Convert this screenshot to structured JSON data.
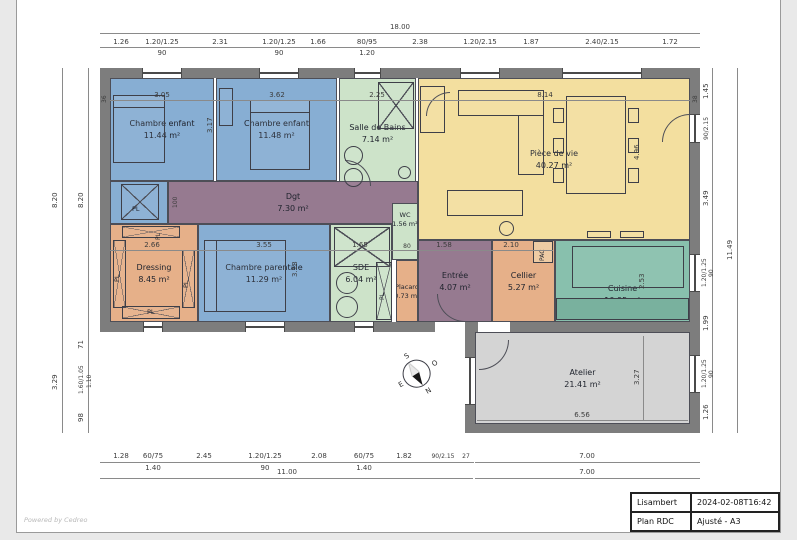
{
  "meta": {
    "watermark": "Powered by Cedreo"
  },
  "title_block": {
    "owner": "Lisambert",
    "timestamp": "2024-02-08T16:42",
    "plan_name": "Plan RDC",
    "variant": "Ajusté - A3"
  },
  "colors": {
    "blue": "#87aed3",
    "green": "#cde3c9",
    "yellow": "#f3df9f",
    "mauve": "#967a90",
    "orange": "#e6b089",
    "teal": "#88c0ad",
    "teal_dark": "#79b19e",
    "gray_room": "#d4d4d4",
    "wall": "#7d7d7d",
    "pac": "#e6b089"
  },
  "rooms": {
    "chambre1": {
      "name": "Chambre enfant",
      "area": "11.44 m²"
    },
    "chambre2": {
      "name": "Chambre enfant",
      "area": "11.48 m²"
    },
    "sdb": {
      "name": "Salle de Bains",
      "area": "7.14 m²"
    },
    "piece": {
      "name": "Pièce de vie",
      "area": "40.27 m²"
    },
    "dgt": {
      "name": "Dgt",
      "area": "7.30 m²"
    },
    "dressing": {
      "name": "Dressing",
      "area": "8.45 m²"
    },
    "parentale": {
      "name": "Chambre parentale",
      "area": "11.29 m²"
    },
    "sde": {
      "name": "SDE",
      "area": "6.04 m²"
    },
    "wc": {
      "name": "WC",
      "area": "1.56 m²"
    },
    "placard": {
      "name": "Placard",
      "area": "0.73 m²"
    },
    "entree": {
      "name": "Entrée",
      "area": "4.07 m²"
    },
    "cellier": {
      "name": "Cellier",
      "area": "5.27 m²"
    },
    "cuisine": {
      "name": "Cuisine",
      "area": "10.95 m²"
    },
    "atelier": {
      "name": "Atelier",
      "area": "21.41 m²"
    }
  },
  "labels": {
    "pl": "PL",
    "pac": "PAC"
  },
  "compass": {
    "top": "S",
    "right": "O",
    "bottom": "N",
    "left": "E"
  },
  "dims": {
    "top_overall": "18.00",
    "top": [
      "1.26",
      "1.20/1.25",
      "2.31",
      "1.20/1.25",
      "1.66",
      "80/95",
      "2.38",
      "1.20/2.15",
      "1.87",
      "2.40/2.15",
      "1.72"
    ],
    "top_sub": [
      "90",
      "90",
      "1.20"
    ],
    "bottom": [
      "1.28",
      "60/75",
      "2.45",
      "1.20/1.25",
      "2.08",
      "60/75",
      "1.82",
      "90/2.15",
      "27",
      "7.00"
    ],
    "bottom_sub": [
      "1.40",
      "90",
      "1.40"
    ],
    "bottom_overall": [
      "11.00",
      "7.00"
    ],
    "left_outer": [
      "8.20",
      "3.29"
    ],
    "left_inner": [
      "8.20",
      "71",
      "1.60/1.05",
      "98"
    ],
    "left_inner_sub": "1.10",
    "right": [
      "1.45",
      "90/2.15",
      "3.49",
      "1.20/1.25",
      "1.99",
      "1.20/1.25",
      "1.26"
    ],
    "right_sub": [
      "90",
      "90"
    ],
    "right_overall": "11.49",
    "int_top": [
      "36",
      "3.05",
      "3.62",
      "2.25",
      "8.14",
      "38"
    ],
    "int_mid": [
      "2.66",
      "3.55",
      "1.65",
      "80",
      "1.58",
      "2.10"
    ],
    "vert": {
      "dgt": "100",
      "chambre2": "3.17",
      "piece": "4.96",
      "parentale": "3.18",
      "cuisine": "2.53",
      "atelier": "3.27"
    },
    "atelier_w": "6.56"
  }
}
